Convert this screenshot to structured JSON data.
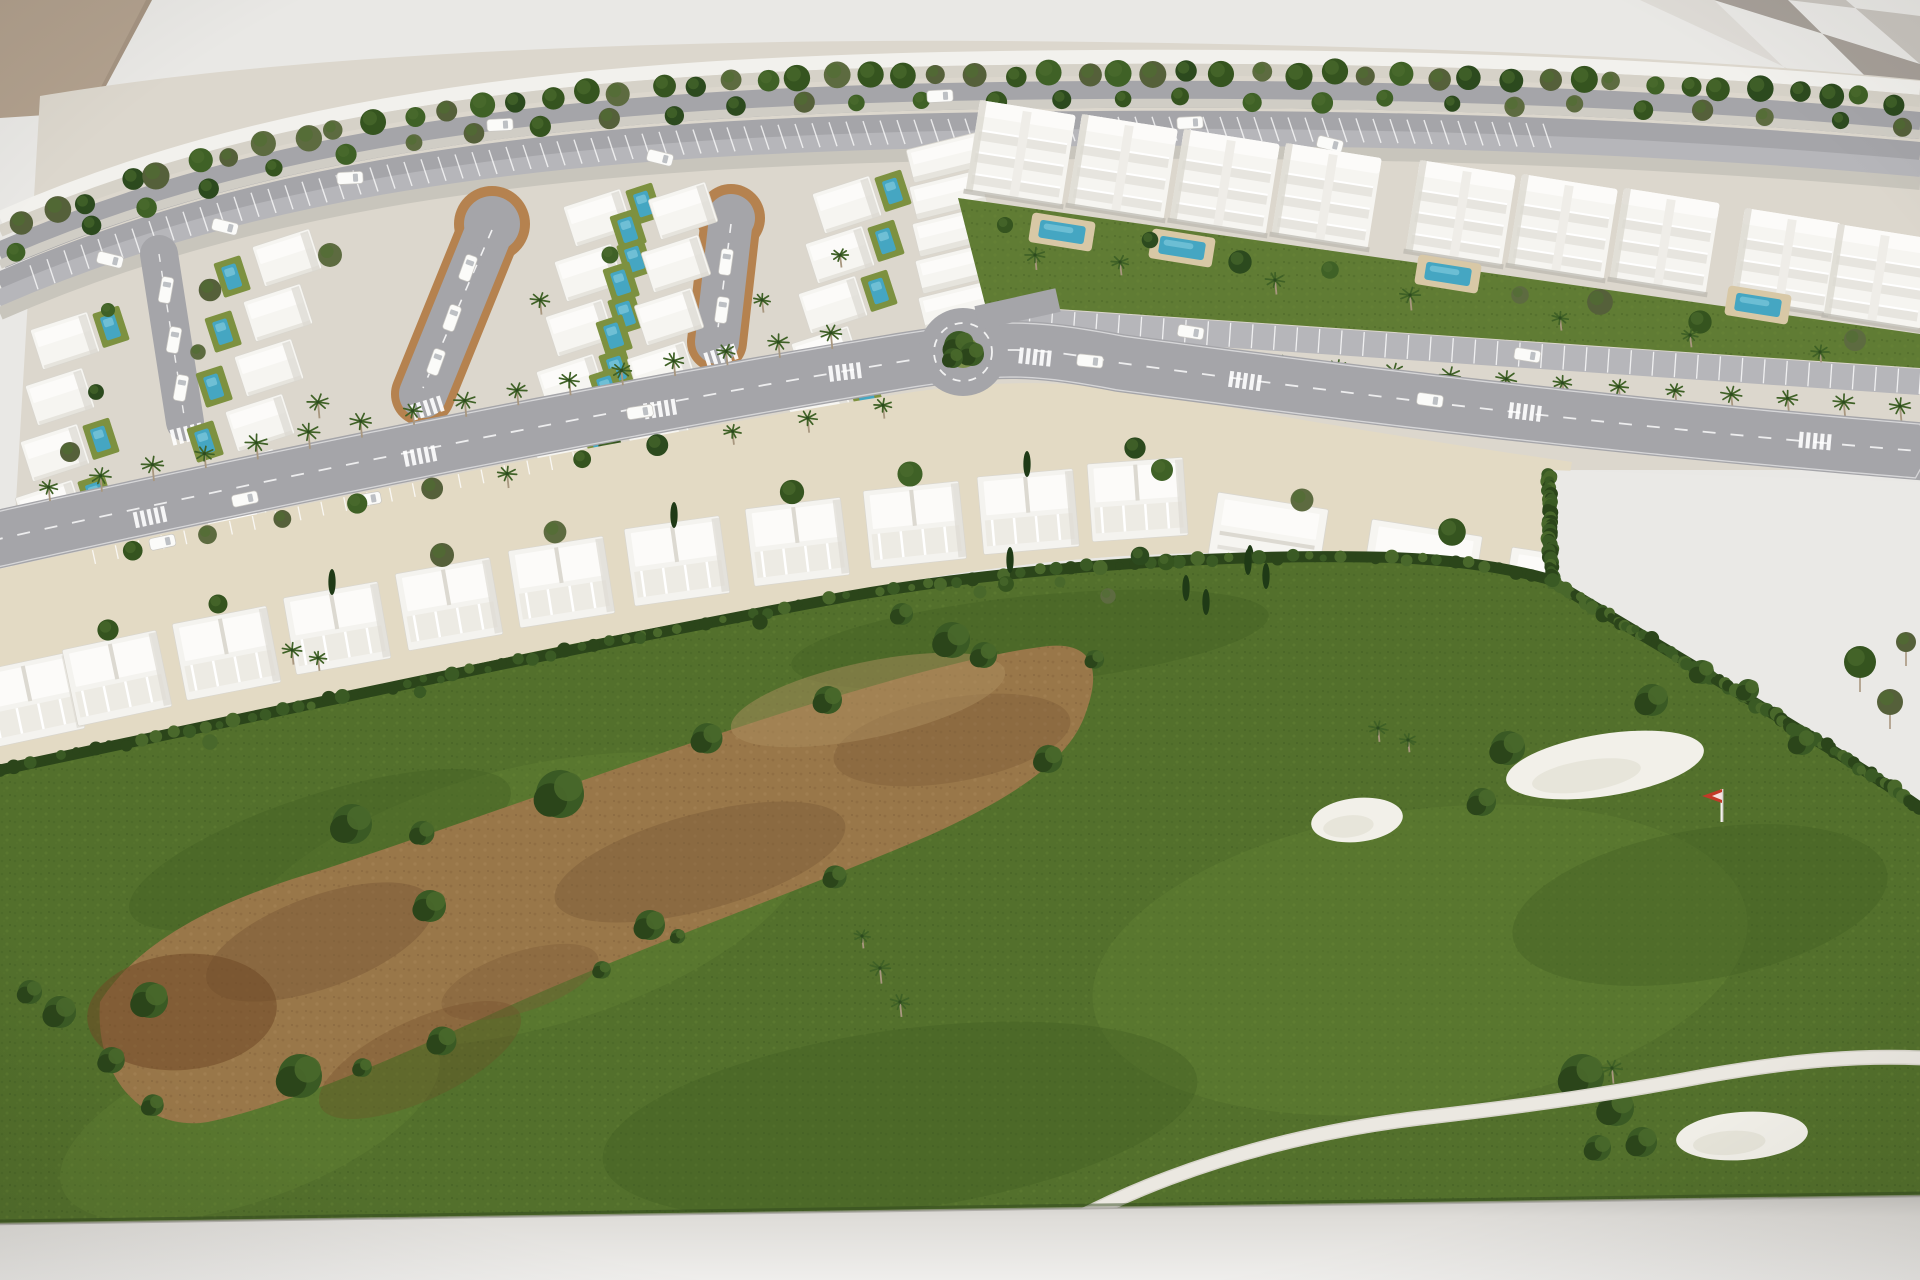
{
  "meta": {
    "subject": "Photograph of an architectural scale model of a golf resort residential development with villas, apartment blocks, palm-lined avenue, roundabout and golf course",
    "width": 1920,
    "height": 1280
  },
  "palette": {
    "bg": "#e9e8e5",
    "beamA": "#a7a099",
    "beamB": "#c9c5bf",
    "beamC": "#dedbd6",
    "beige": "#b2a18e",
    "rim": "#f2f1ed",
    "sand": "#d6d2c8",
    "road": "#a5a5a9",
    "median": "#d0cdc5",
    "parking": "#b6b6ba",
    "verge": "#c8c5bc",
    "urban": "#dcd7cd",
    "plots": "#e3dac4",
    "curb": "#b5824f",
    "white": "#f6f5f1",
    "roofLight": "#fcfbf9",
    "houseShadow": "#dcd9d1",
    "houseLine": "#d9d6ce",
    "lawn": "#607c34",
    "lawnLight": "#7d9140",
    "poolDeck": "#d8c8a6",
    "poolWater": "#45a6c2",
    "poolLight": "#79c6da",
    "green": "#53702c",
    "greenLight": "#6d8b38",
    "greenDark": "#3f5a22",
    "hedge": "#2b451a",
    "hedge2": "#3a5a24",
    "hedge3": "#49682b",
    "dirt": "#997749",
    "dirtDark": "#7b5a37",
    "dirtRed": "#6f4827",
    "dirtLight": "#ac8d5e",
    "bunker": "#f2f0e9",
    "cart": "#ebe8e1",
    "base": "#d8d6d2",
    "baseLight": "#efeeec",
    "treeShades": [
      "#2c4a1e",
      "#35541f",
      "#3f6126",
      "#5d6b40",
      "#55603a"
    ],
    "treeHi": "#4e7030",
    "palmGreen": "#3f6126",
    "trunk": "#a8977f",
    "cypress": "#1f3a16",
    "flagRed": "#c23a28",
    "car": "#fbfbf9",
    "carLine": "#c9c7c2",
    "wedge": "#eae9e6"
  },
  "background": {
    "beams": [
      {
        "pts": "1640,0 1714,0 1920,198 1920,130",
        "color_key": "beamC"
      },
      {
        "pts": "1714,0 1788,0 1920,130 1920,64",
        "color_key": "beamA"
      },
      {
        "pts": "1788,0 1846,0 1920,64 1920,16",
        "color_key": "beamB"
      }
    ],
    "beige_corner": "0,0 152,0 92,112 0,118"
  },
  "urban_base": "M 40 96 C 300 52 700 36 1100 42 C 1450 47 1700 58 1920 80 L 1920 470 L 1552 470 L 1551 580 C 1440 564 1300 552 1200 553 C 1040 556 900 580 760 610 C 560 652 300 710 0 772 Z",
  "boulevard": {
    "guide": "M 0 212 C 260 98 560 58 1000 52 C 1400 46 1700 62 1920 82",
    "bands": [
      {
        "o": -1,
        "w": 14,
        "key": "rim"
      },
      {
        "o": 13,
        "w": 12,
        "key": "sand"
      },
      {
        "o": 30,
        "w": 27,
        "key": "road"
      },
      {
        "o": 48,
        "w": 9,
        "key": "median"
      },
      {
        "o": 60,
        "w": 25,
        "key": "road"
      },
      {
        "o": 78,
        "w": 29,
        "key": "parking"
      },
      {
        "o": 95,
        "w": 13,
        "key": "verge"
      }
    ],
    "tree_rows": [
      {
        "o": 22,
        "n": 54,
        "rmin": 9,
        "rmax": 14
      },
      {
        "o": 48,
        "n": 30,
        "rmin": 8,
        "rmax": 11
      }
    ],
    "tick_band": {
      "o1": 66,
      "o2": 90,
      "x1": 30,
      "x2": 1560,
      "step": 17,
      "slant": 8
    },
    "road_cars": [
      {
        "x": 500,
        "o": 43
      },
      {
        "x": 940,
        "o": 43
      },
      {
        "x": 350,
        "o": 72
      },
      {
        "x": 1190,
        "o": 72
      }
    ],
    "parked_cars": [
      {
        "x": 110,
        "o": 78
      },
      {
        "x": 225,
        "o": 78
      },
      {
        "x": 660,
        "o": 78
      },
      {
        "x": 1040,
        "o": 78
      },
      {
        "x": 1330,
        "o": 78
      }
    ]
  },
  "villas": {
    "loops": [
      {
        "x1": 492,
        "y1": 224,
        "x2": 423,
        "y2": 394,
        "w": 48,
        "bulb": 28
      },
      {
        "x1": 731,
        "y1": 218,
        "x2": 717,
        "y2": 342,
        "w": 44,
        "bulb": 24
      }
    ],
    "street": {
      "x1": 159,
      "y1": 254,
      "x2": 185,
      "y2": 422,
      "w": 38
    },
    "columns": [
      {
        "x": 30,
        "y": 330,
        "dx": -5,
        "dy": 56,
        "n": 4,
        "pool": 1
      },
      {
        "x": 252,
        "y": 247,
        "dx": -9,
        "dy": 55,
        "n": 6,
        "pool": -1
      },
      {
        "x": 563,
        "y": 207,
        "dx": -9,
        "dy": 55,
        "n": 6,
        "pool": 1
      },
      {
        "x": 648,
        "y": 200,
        "dx": -7,
        "dy": 53,
        "n": 6,
        "pool": -1
      },
      {
        "x": 812,
        "y": 194,
        "dx": -7,
        "dy": 50,
        "n": 6,
        "pool": 1
      }
    ],
    "big_houses": {
      "x": 906,
      "y": 150,
      "dx": 3,
      "dy": 37,
      "n": 6
    },
    "loop_cars": [
      [
        468,
        268,
        -70
      ],
      [
        452,
        318,
        -70
      ],
      [
        436,
        362,
        -70
      ],
      [
        726,
        262,
        -82
      ],
      [
        722,
        310,
        -82
      ]
    ],
    "street_cars": [
      [
        166,
        290,
        -80
      ],
      [
        174,
        340,
        -80
      ],
      [
        181,
        388,
        -80
      ]
    ],
    "trees": [
      [
        210,
        290
      ],
      [
        198,
        352
      ],
      [
        330,
        255
      ],
      [
        318,
        402
      ],
      [
        540,
        300
      ],
      [
        548,
        420
      ],
      [
        610,
        255
      ],
      [
        700,
        380
      ],
      [
        762,
        300
      ],
      [
        840,
        255
      ],
      [
        858,
        380
      ],
      [
        108,
        310
      ],
      [
        96,
        392
      ],
      [
        926,
        360
      ],
      [
        70,
        452
      ],
      [
        240,
        470
      ],
      [
        420,
        455
      ],
      [
        610,
        446
      ],
      [
        788,
        430
      ],
      [
        905,
        418
      ]
    ]
  },
  "apartments": {
    "rot": 9,
    "blocks": [
      [
        980,
        100
      ],
      [
        1082,
        114
      ],
      [
        1184,
        129
      ],
      [
        1286,
        143
      ],
      [
        1420,
        160
      ],
      [
        1522,
        174
      ],
      [
        1624,
        188
      ],
      [
        1745,
        208
      ],
      [
        1838,
        224
      ]
    ],
    "lawn": "M 958 198 L 1920 334 L 1920 368 L 985 304 Z",
    "pools": [
      [
        1062,
        232
      ],
      [
        1182,
        248
      ],
      [
        1448,
        274
      ],
      [
        1758,
        305
      ]
    ],
    "lawn_trees": [
      [
        1005,
        225
      ],
      [
        1150,
        240
      ],
      [
        1240,
        262
      ],
      [
        1330,
        270
      ],
      [
        1520,
        295
      ],
      [
        1600,
        302
      ],
      [
        1700,
        322
      ],
      [
        1855,
        340
      ]
    ],
    "lawn_palms": [
      [
        1035,
        255
      ],
      [
        1120,
        262
      ],
      [
        1275,
        280
      ],
      [
        1410,
        295
      ],
      [
        1560,
        318
      ],
      [
        1690,
        335
      ],
      [
        1820,
        352
      ]
    ],
    "parking": {
      "x1": 985,
      "y1": 318,
      "x2": 1920,
      "y2": 382,
      "w": 26,
      "ticks": 42
    },
    "palm_row": {
      "x1": 1000,
      "y1": 338,
      "x2": 1900,
      "y2": 400,
      "n": 17
    }
  },
  "avenue": {
    "path": "M -10 541 C 300 472 620 408 905 361 C 1000 346 1030 346 1120 363 C 1350 394 1600 425 1930 452",
    "width": 58,
    "crosswalks": [
      [
        150,
        517,
        -12
      ],
      [
        420,
        456,
        -11
      ],
      [
        660,
        409,
        -9
      ],
      [
        845,
        372,
        -7
      ],
      [
        1035,
        357,
        6
      ],
      [
        1245,
        381,
        8
      ],
      [
        1525,
        412,
        7
      ],
      [
        1815,
        441,
        5
      ]
    ],
    "cars": [
      [
        245,
        499,
        -12
      ],
      [
        640,
        412,
        -9
      ],
      [
        1090,
        361,
        6
      ],
      [
        1430,
        400,
        8
      ]
    ],
    "palm_line": {
      "from": 0.035,
      "to": 0.44,
      "n": 16,
      "off": -40
    },
    "tree_line": {
      "from": 0.07,
      "to": 0.46,
      "n": 11,
      "off": 40
    },
    "park_ticks": {
      "from": 0.05,
      "to": 0.3,
      "n": 22,
      "o1": 31,
      "o2": 45
    }
  },
  "roundabout": {
    "cx": 963,
    "cy": 352,
    "r": 44,
    "ring": 29,
    "island": 16
  },
  "townhouses": {
    "ground": "M -15 572 C 280 508 600 442 900 394 C 1000 378 1080 380 1180 398 C 1320 424 1460 446 1572 462 L 1551 580 C 1440 564 1300 552 1200 553 C 1040 556 900 580 760 610 C 560 652 300 710 -15 775 Z",
    "clusters": [
      [
        -25,
        672,
        -12
      ],
      [
        62,
        650,
        -12
      ],
      [
        172,
        624,
        -11
      ],
      [
        283,
        598,
        -10
      ],
      [
        395,
        574,
        -10
      ],
      [
        508,
        551,
        -9
      ],
      [
        624,
        529,
        -8
      ],
      [
        745,
        509,
        -7
      ],
      [
        863,
        491,
        -6
      ],
      [
        977,
        477,
        -5
      ],
      [
        1087,
        464,
        -4
      ]
    ],
    "trees": [
      [
        58,
        640
      ],
      [
        168,
        614
      ],
      [
        280,
        588
      ],
      [
        392,
        565
      ],
      [
        505,
        542
      ],
      [
        622,
        521
      ],
      [
        742,
        502
      ],
      [
        860,
        484
      ],
      [
        975,
        470
      ],
      [
        1085,
        458
      ]
    ]
  },
  "detached": {
    "houses": [
      [
        1218,
        492,
        9
      ],
      [
        1372,
        519,
        9
      ],
      [
        1512,
        547,
        9
      ]
    ],
    "trees": [
      [
        1162,
        470
      ],
      [
        1302,
        500
      ],
      [
        1452,
        532
      ],
      [
        1560,
        505
      ]
    ],
    "cypresses": [
      [
        1250,
        558
      ],
      [
        1430,
        582
      ]
    ]
  },
  "wedge": "M 1548 470 L 1920 482 L 1920 802 C 1840 750 1690 662 1550 582 Z",
  "golf": {
    "green": "M 0 772 C 240 718 520 648 780 606 C 950 578 1120 556 1300 556 C 1400 556 1480 566 1548 580 C 1700 668 1840 752 1920 806 L 1920 1198 L 0 1226 Z",
    "hedges": [
      "M 0 770 C 300 706 600 642 850 596 C 1000 570 1200 554 1370 557 C 1440 558 1500 566 1548 579",
      "M 1548 579 C 1690 664 1840 752 1918 806",
      "M 1549 474 L 1551 580"
    ],
    "light_patches": [
      [
        520,
        900,
        300,
        130,
        -15
      ],
      [
        1420,
        960,
        330,
        150,
        -8
      ],
      [
        250,
        1120,
        200,
        80,
        -20
      ]
    ],
    "dark_patches": [
      [
        320,
        850,
        200,
        55,
        -18
      ],
      [
        1030,
        640,
        240,
        44,
        -6
      ],
      [
        1700,
        905,
        190,
        75,
        -10
      ],
      [
        900,
        1120,
        300,
        90,
        -8
      ]
    ],
    "dirt": "M 100 1002 C 140 938 225 898 322 870 C 480 818 640 758 792 710 C 882 682 980 654 1048 646 C 1092 642 1102 668 1086 712 C 1070 762 1008 800 928 836 C 798 892 658 940 518 1002 C 398 1056 298 1102 208 1122 C 148 1132 94 1082 100 1002 Z",
    "dirt_patches": [
      [
        320,
        942,
        120,
        46,
        -20,
        "dirtDark",
        0.5
      ],
      [
        700,
        862,
        150,
        48,
        -15,
        "dirtDark",
        0.45
      ],
      [
        952,
        740,
        120,
        42,
        -10,
        "dirtDark",
        0.4
      ],
      [
        182,
        1012,
        95,
        58,
        -5,
        "dirtRed",
        0.55
      ],
      [
        520,
        982,
        82,
        30,
        -18,
        "dirtDark",
        0.35
      ],
      [
        868,
        700,
        140,
        38,
        -12,
        "dirtLight",
        0.5
      ],
      [
        420,
        1060,
        110,
        40,
        -25,
        "dirtRed",
        0.3
      ]
    ],
    "edge_bush_pts": [
      [
        110,
        990
      ],
      [
        152,
        926
      ],
      [
        230,
        896
      ],
      [
        322,
        870
      ],
      [
        422,
        838
      ],
      [
        520,
        800
      ],
      [
        622,
        764
      ],
      [
        712,
        734
      ],
      [
        800,
        704
      ],
      [
        892,
        678
      ],
      [
        962,
        660
      ],
      [
        1040,
        646
      ],
      [
        1090,
        662
      ],
      [
        1082,
        708
      ],
      [
        1048,
        762
      ],
      [
        988,
        796
      ],
      [
        918,
        840
      ],
      [
        838,
        872
      ],
      [
        758,
        906
      ],
      [
        678,
        936
      ],
      [
        598,
        968
      ],
      [
        518,
        1002
      ],
      [
        438,
        1036
      ],
      [
        358,
        1068
      ],
      [
        278,
        1098
      ],
      [
        208,
        1120
      ],
      [
        148,
        1104
      ],
      [
        112,
        1058
      ]
    ],
    "big_bushes": [
      [
        560,
        794,
        24
      ],
      [
        352,
        824,
        20
      ],
      [
        300,
        1076,
        22
      ],
      [
        150,
        1000,
        18
      ],
      [
        430,
        906,
        16
      ],
      [
        650,
        925,
        15
      ],
      [
        828,
        700,
        14
      ],
      [
        60,
        1012,
        16
      ],
      [
        30,
        992,
        12
      ],
      [
        1508,
        748,
        17
      ],
      [
        1540,
        778,
        13
      ],
      [
        1482,
        802,
        14
      ],
      [
        1652,
        700,
        16
      ],
      [
        1702,
        672,
        12
      ],
      [
        1748,
        690,
        11
      ],
      [
        1802,
        742,
        13
      ],
      [
        952,
        640,
        18
      ],
      [
        984,
        655,
        13
      ],
      [
        902,
        614,
        11
      ]
    ],
    "cluster_br": [
      [
        1582,
        1076,
        22
      ],
      [
        1616,
        1108,
        18
      ],
      [
        1642,
        1142,
        15
      ],
      [
        1598,
        1148,
        13
      ]
    ],
    "right_trees": [
      [
        1860,
        662,
        16
      ],
      [
        1890,
        702,
        13
      ],
      [
        1906,
        642,
        10
      ]
    ],
    "cypresses": [
      [
        1186,
        588
      ],
      [
        1206,
        602
      ],
      [
        1248,
        562
      ],
      [
        1266,
        576
      ],
      [
        1010,
        560
      ]
    ],
    "hedge_dots": [
      [
        210,
        742
      ],
      [
        420,
        692
      ],
      [
        640,
        638
      ],
      [
        760,
        622
      ],
      [
        980,
        592
      ],
      [
        1060,
        582
      ]
    ],
    "palms": [
      [
        862,
        936
      ],
      [
        880,
        968
      ],
      [
        900,
        1002
      ],
      [
        1378,
        728
      ],
      [
        1408,
        740
      ],
      [
        1612,
        1068
      ],
      [
        292,
        650
      ],
      [
        318,
        658
      ]
    ],
    "small_trees": [
      [
        1006,
        584
      ],
      [
        1108,
        596
      ],
      [
        1140,
        556
      ],
      [
        1166,
        562
      ]
    ],
    "bunkers": [
      [
        1357,
        820,
        46,
        22,
        -6
      ],
      [
        1605,
        765,
        100,
        31,
        -9
      ],
      [
        1742,
        1136,
        66,
        24,
        -4
      ]
    ],
    "flag": {
      "x": 1722,
      "y_base": 822,
      "y_top": 789
    },
    "cart_path": "M 978 1284 C 1080 1200 1240 1140 1420 1118 C 1540 1104 1610 1094 1705 1076 C 1795 1060 1862 1055 1924 1058"
  },
  "base_band": {
    "pts": "0,1224 1920,1196 1920,1280 0,1280"
  }
}
